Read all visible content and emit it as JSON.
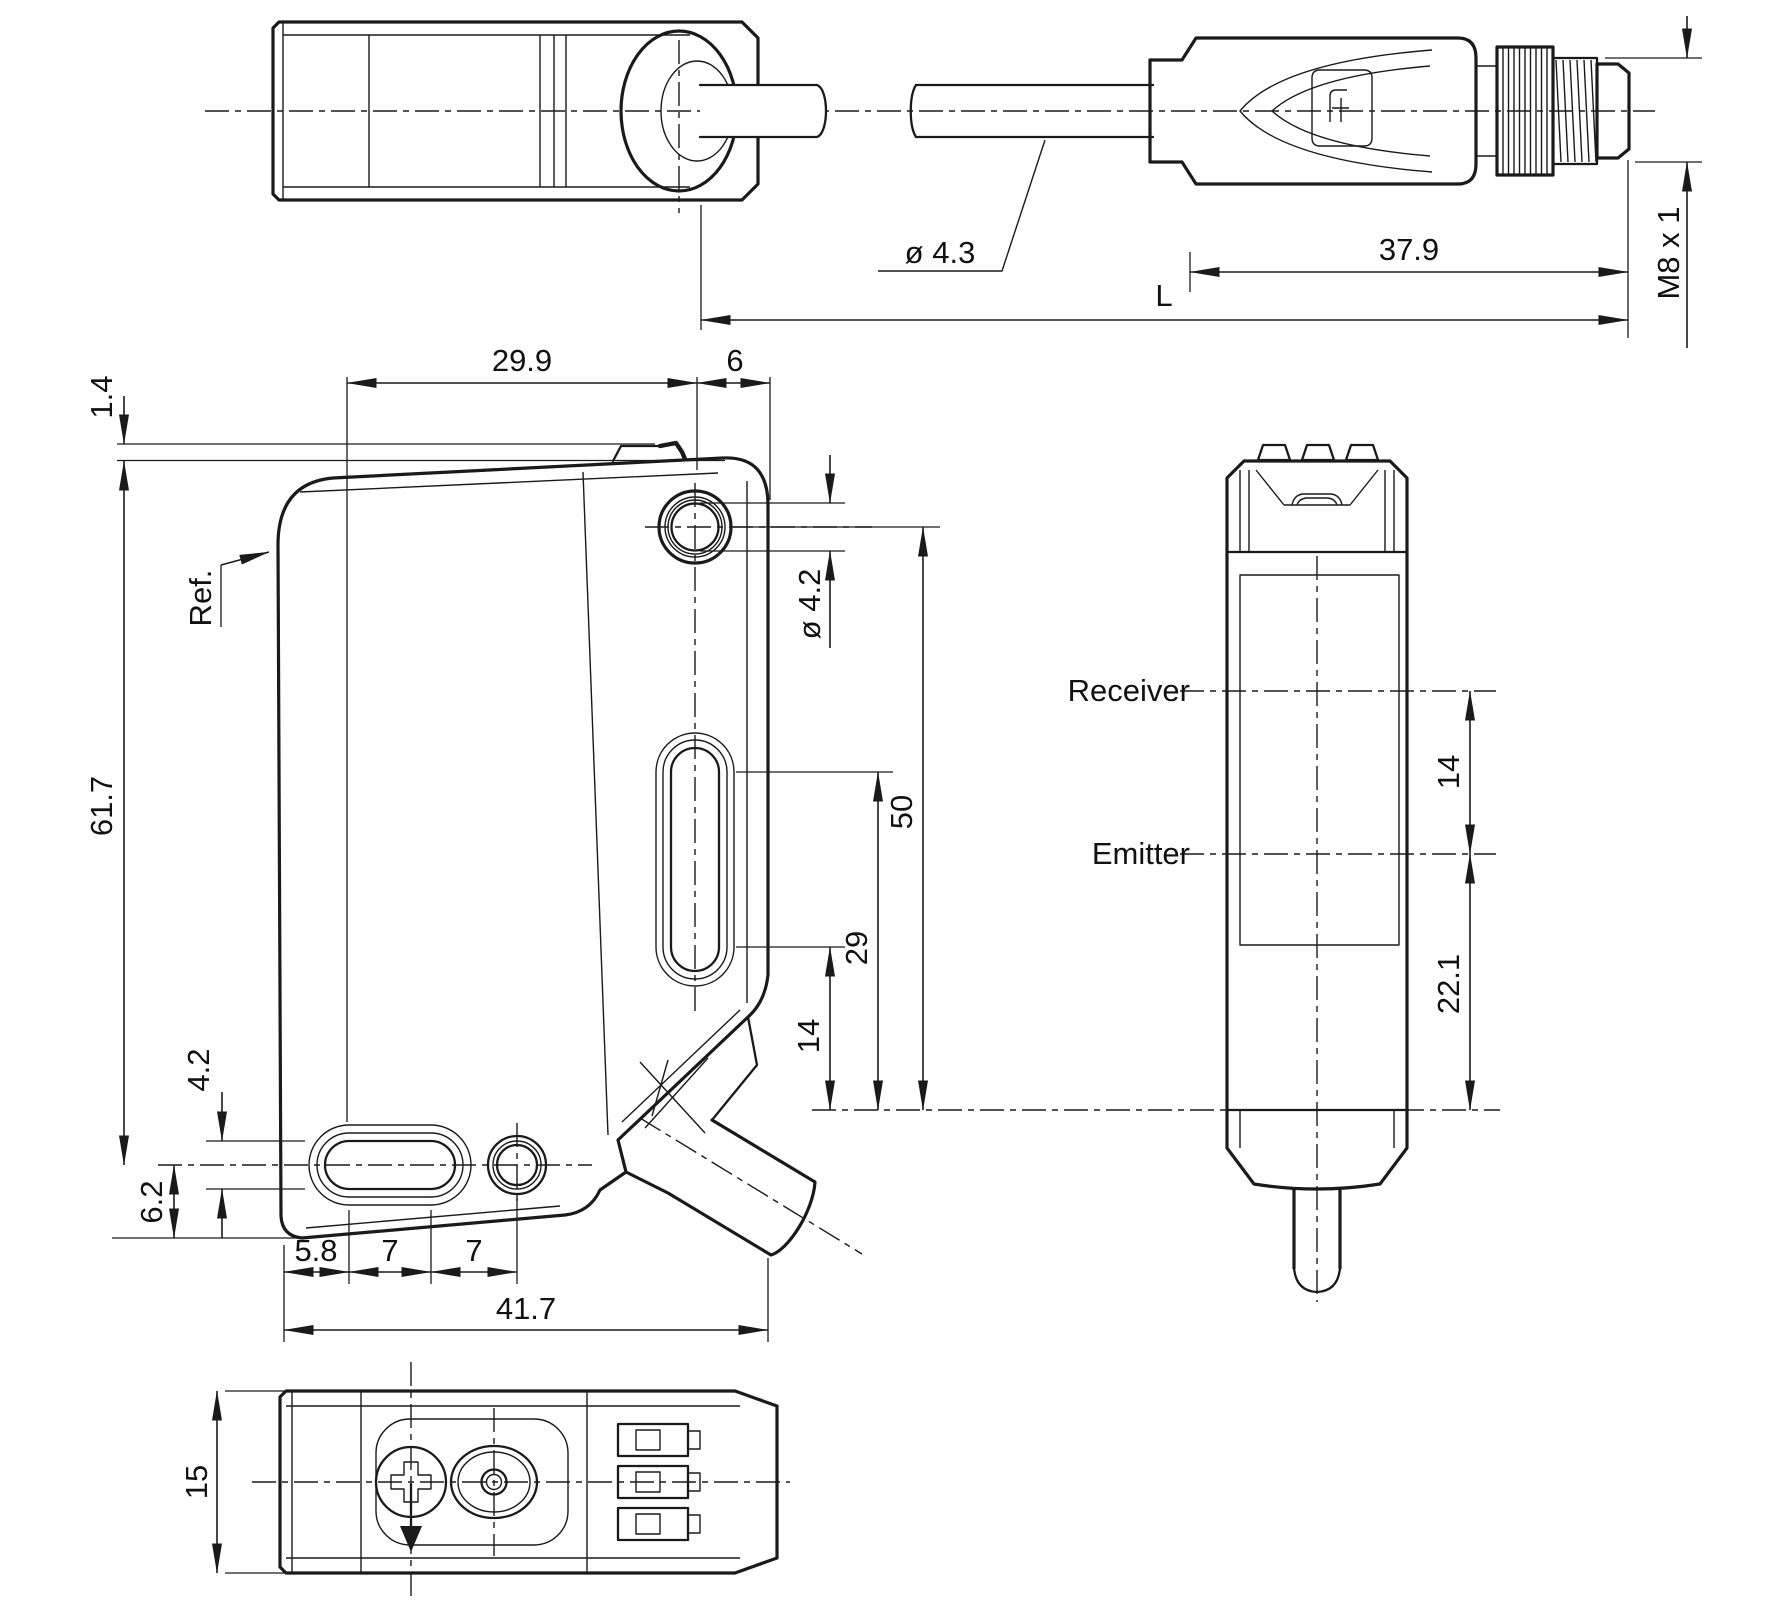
{
  "drawing_type": "sensor-dimensional-drawing",
  "colors": {
    "line": "#1a1a1a",
    "background": "#ffffff"
  },
  "views": {
    "top": {
      "name": "top-view-with-cable-and-connector",
      "dims": {
        "cable_diameter": "ø 4.3",
        "connector_length": "37.9",
        "total_length": "L",
        "thread_spec": "M8 x 1"
      }
    },
    "side": {
      "name": "side-view",
      "labels": {
        "reference": "Ref."
      },
      "dims": {
        "rail_height": "1.4",
        "hole_offset": "29.9",
        "hole_to_edge": "6",
        "body_height": "61.7",
        "hole_diameter": "ø 4.2",
        "hole_to_axis": "50",
        "slot_top_to_axis": "29",
        "slot_bottom_to_axis": "14",
        "slot_width": "4.2",
        "slot_to_bottom": "6.2",
        "edge_to_slot": "5.8",
        "pitch_a": "7",
        "pitch_b": "7",
        "body_width": "41.7"
      }
    },
    "front": {
      "name": "front-view",
      "labels": {
        "receiver": "Receiver",
        "emitter": "Emitter"
      },
      "dims": {
        "beam_spacing": "14",
        "emitter_to_bottom": "22.1"
      }
    },
    "bottom": {
      "name": "bottom-view",
      "dims": {
        "body_depth": "15"
      }
    }
  }
}
